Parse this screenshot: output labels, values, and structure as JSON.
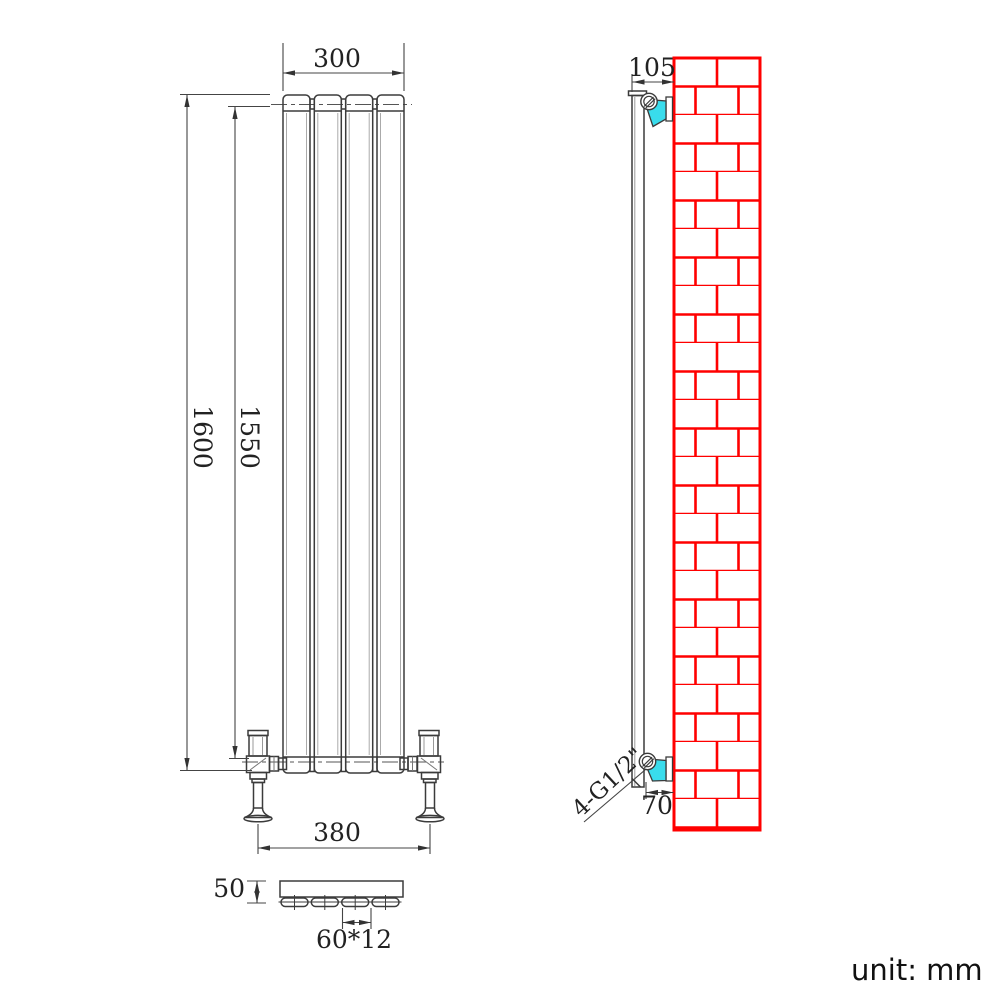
{
  "drawing": {
    "type": "radiator-technical-drawing",
    "unit_label": "unit: mm",
    "dimensions": {
      "top_width": "300",
      "overall_height": "1600",
      "panel_height": "1550",
      "valve_spacing": "380",
      "depth": "50",
      "panel_pitch": "60*12",
      "wall_offset_top": "105",
      "wall_offset_bottom": "70",
      "thread_label": "4-G1/2\""
    },
    "colors": {
      "brick_red": "#ff0000",
      "bracket_cyan": "#39dcec",
      "line_dark": "#3b3b3b"
    }
  }
}
